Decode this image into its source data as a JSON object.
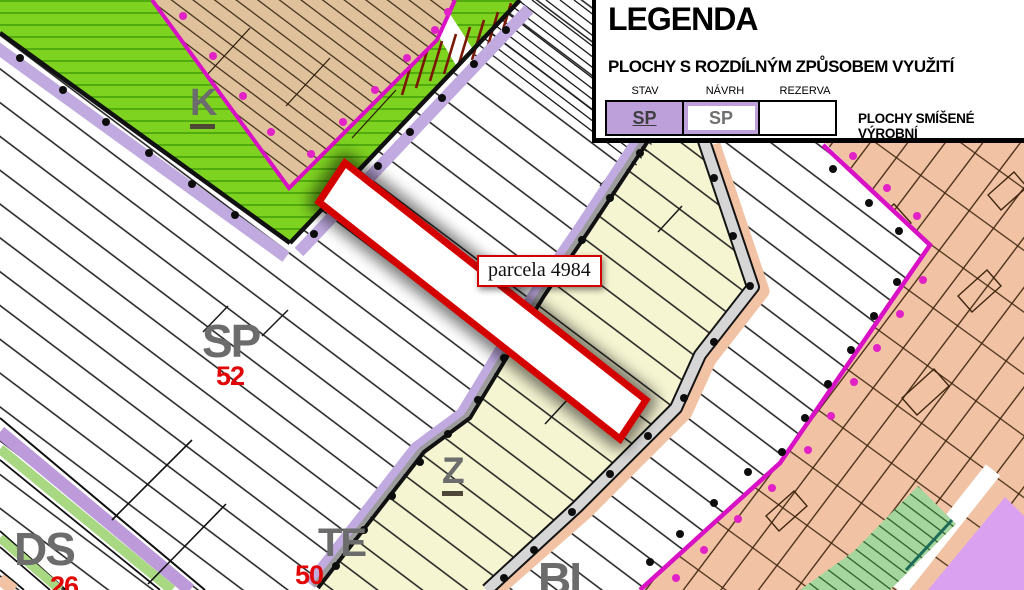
{
  "legend": {
    "title": "LEGENDA",
    "subtitle": "PLOCHY S ROZDÍLNÝM ZPŮSOBEM VYUŽITÍ",
    "columns": [
      "STAV",
      "NÁVRH",
      "REZERVA"
    ],
    "stav_code": "SP",
    "navrh_code": "SP",
    "rezerva_code": "",
    "zone_description": "PLOCHY SMÍŠENÉ VÝROBNÍ"
  },
  "map": {
    "parcel_label": "parcela 4984",
    "zones": [
      {
        "code": "K",
        "number": "",
        "underlined": true
      },
      {
        "code": "SP",
        "number": "52",
        "underlined": false
      },
      {
        "code": "Z",
        "number": "",
        "underlined": true
      },
      {
        "code": "TE",
        "number": "50",
        "underlined": false
      },
      {
        "code": "DS",
        "number": "26",
        "underlined": false
      },
      {
        "code": "BI",
        "number": "",
        "underlined": false
      }
    ]
  },
  "colors": {
    "zone-green": "#7ED321",
    "zone-tan": "#DFC19B",
    "zone-yellow": "#F6F5D2",
    "zone-salmon": "#F1C3A4",
    "zone-violet": "#D9A1F0",
    "zone-palegreen": "#A5D69E",
    "stripe-lavender": "#C0AADF",
    "stripe-purple": "#BD9BDB",
    "stripe-green": "#A9D883",
    "magenta": "#D911C4",
    "legend-purple": "#BD9FDA",
    "label-gray": "#6C6C6C",
    "label-red": "#E10505",
    "parcel-red": "#D40000",
    "road-gray": "#D6D6D6"
  }
}
